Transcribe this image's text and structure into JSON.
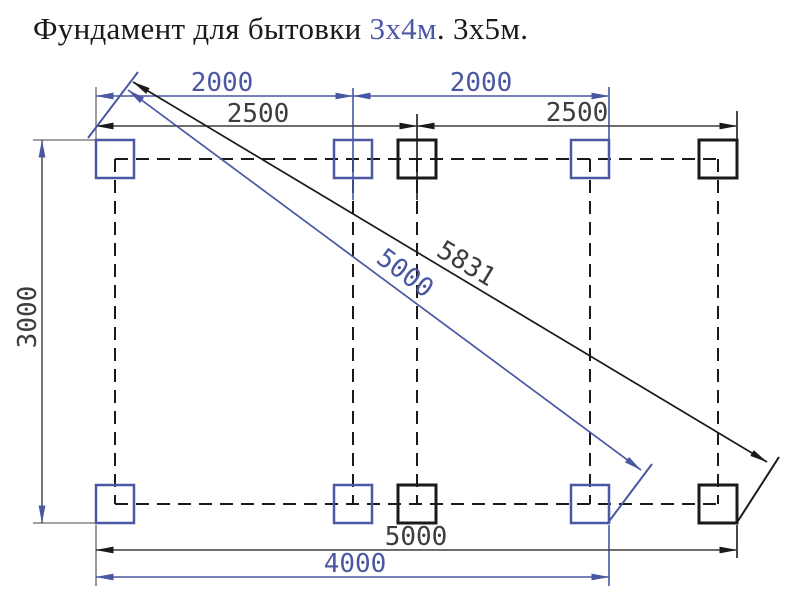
{
  "title": {
    "prefix": "Фундамент для бытовки ",
    "size_blue": "3х4м",
    "suffix": ". 3х5м."
  },
  "dims": {
    "top_left_span": "2000",
    "top_right_span": "2000",
    "mid_left_span": "2500",
    "mid_right_span": "2500",
    "height": "3000",
    "diag_long": "5831",
    "diag_short": "5000",
    "bottom_width_long": "5000",
    "bottom_width_short": "4000"
  },
  "colors": {
    "accent_blue": "#4a57a2",
    "title_accent": "#4d58a8",
    "line_black": "#1a1a1a",
    "dim_text": "#3d3d3d"
  }
}
